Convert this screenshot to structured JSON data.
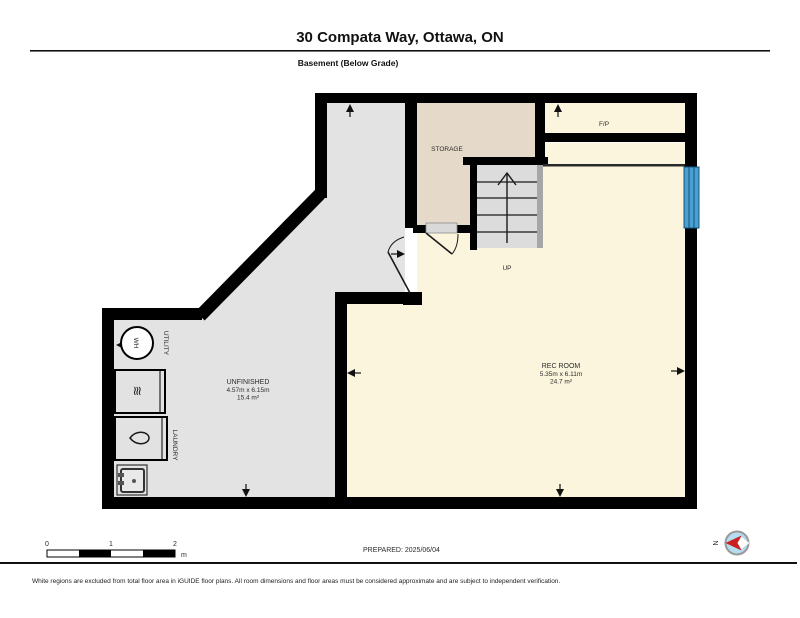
{
  "header": {
    "title": "30 Compata Way, Ottawa, ON",
    "subtitle": "Basement (Below Grade)"
  },
  "rooms": {
    "storage": {
      "label": "STORAGE"
    },
    "fireplace": {
      "label": "F/P"
    },
    "rec_room": {
      "name": "REC ROOM",
      "dims": "5.35m x 6.11m",
      "area": "24.7 m²"
    },
    "unfinished": {
      "name": "UNFINISHED",
      "dims": "4.57m x 6.15m",
      "area": "15.4 m²"
    },
    "utility": {
      "label": "UTILITY"
    },
    "laundry": {
      "label": "LAUNDRY"
    },
    "stairs": {
      "label": "UP"
    },
    "water_heater": {
      "label": "WH"
    }
  },
  "scale_bar": {
    "tick0": "0",
    "tick1": "1",
    "tick2": "2",
    "unit": "m"
  },
  "prepared": {
    "label": "PREPARED: 2025/06/04"
  },
  "compass": {
    "north_label": "N"
  },
  "footer": {
    "disclaimer": "White regions are excluded from total floor area in iGUIDE floor plans. All room dimensions and floor areas must be considered approximate and are subject to independent verification."
  },
  "colors": {
    "floor_gray": "#e3e3e3",
    "storage_tan": "#e5dac9",
    "finished_cream": "#fbf5dd",
    "wall_black": "#000000",
    "stairs_fill": "#dcdcdc",
    "railing_gray": "#a6a6a6",
    "window_blue": "#4aa0d2",
    "compass_blue": "#b5ddf0",
    "compass_red": "#cc2020"
  }
}
